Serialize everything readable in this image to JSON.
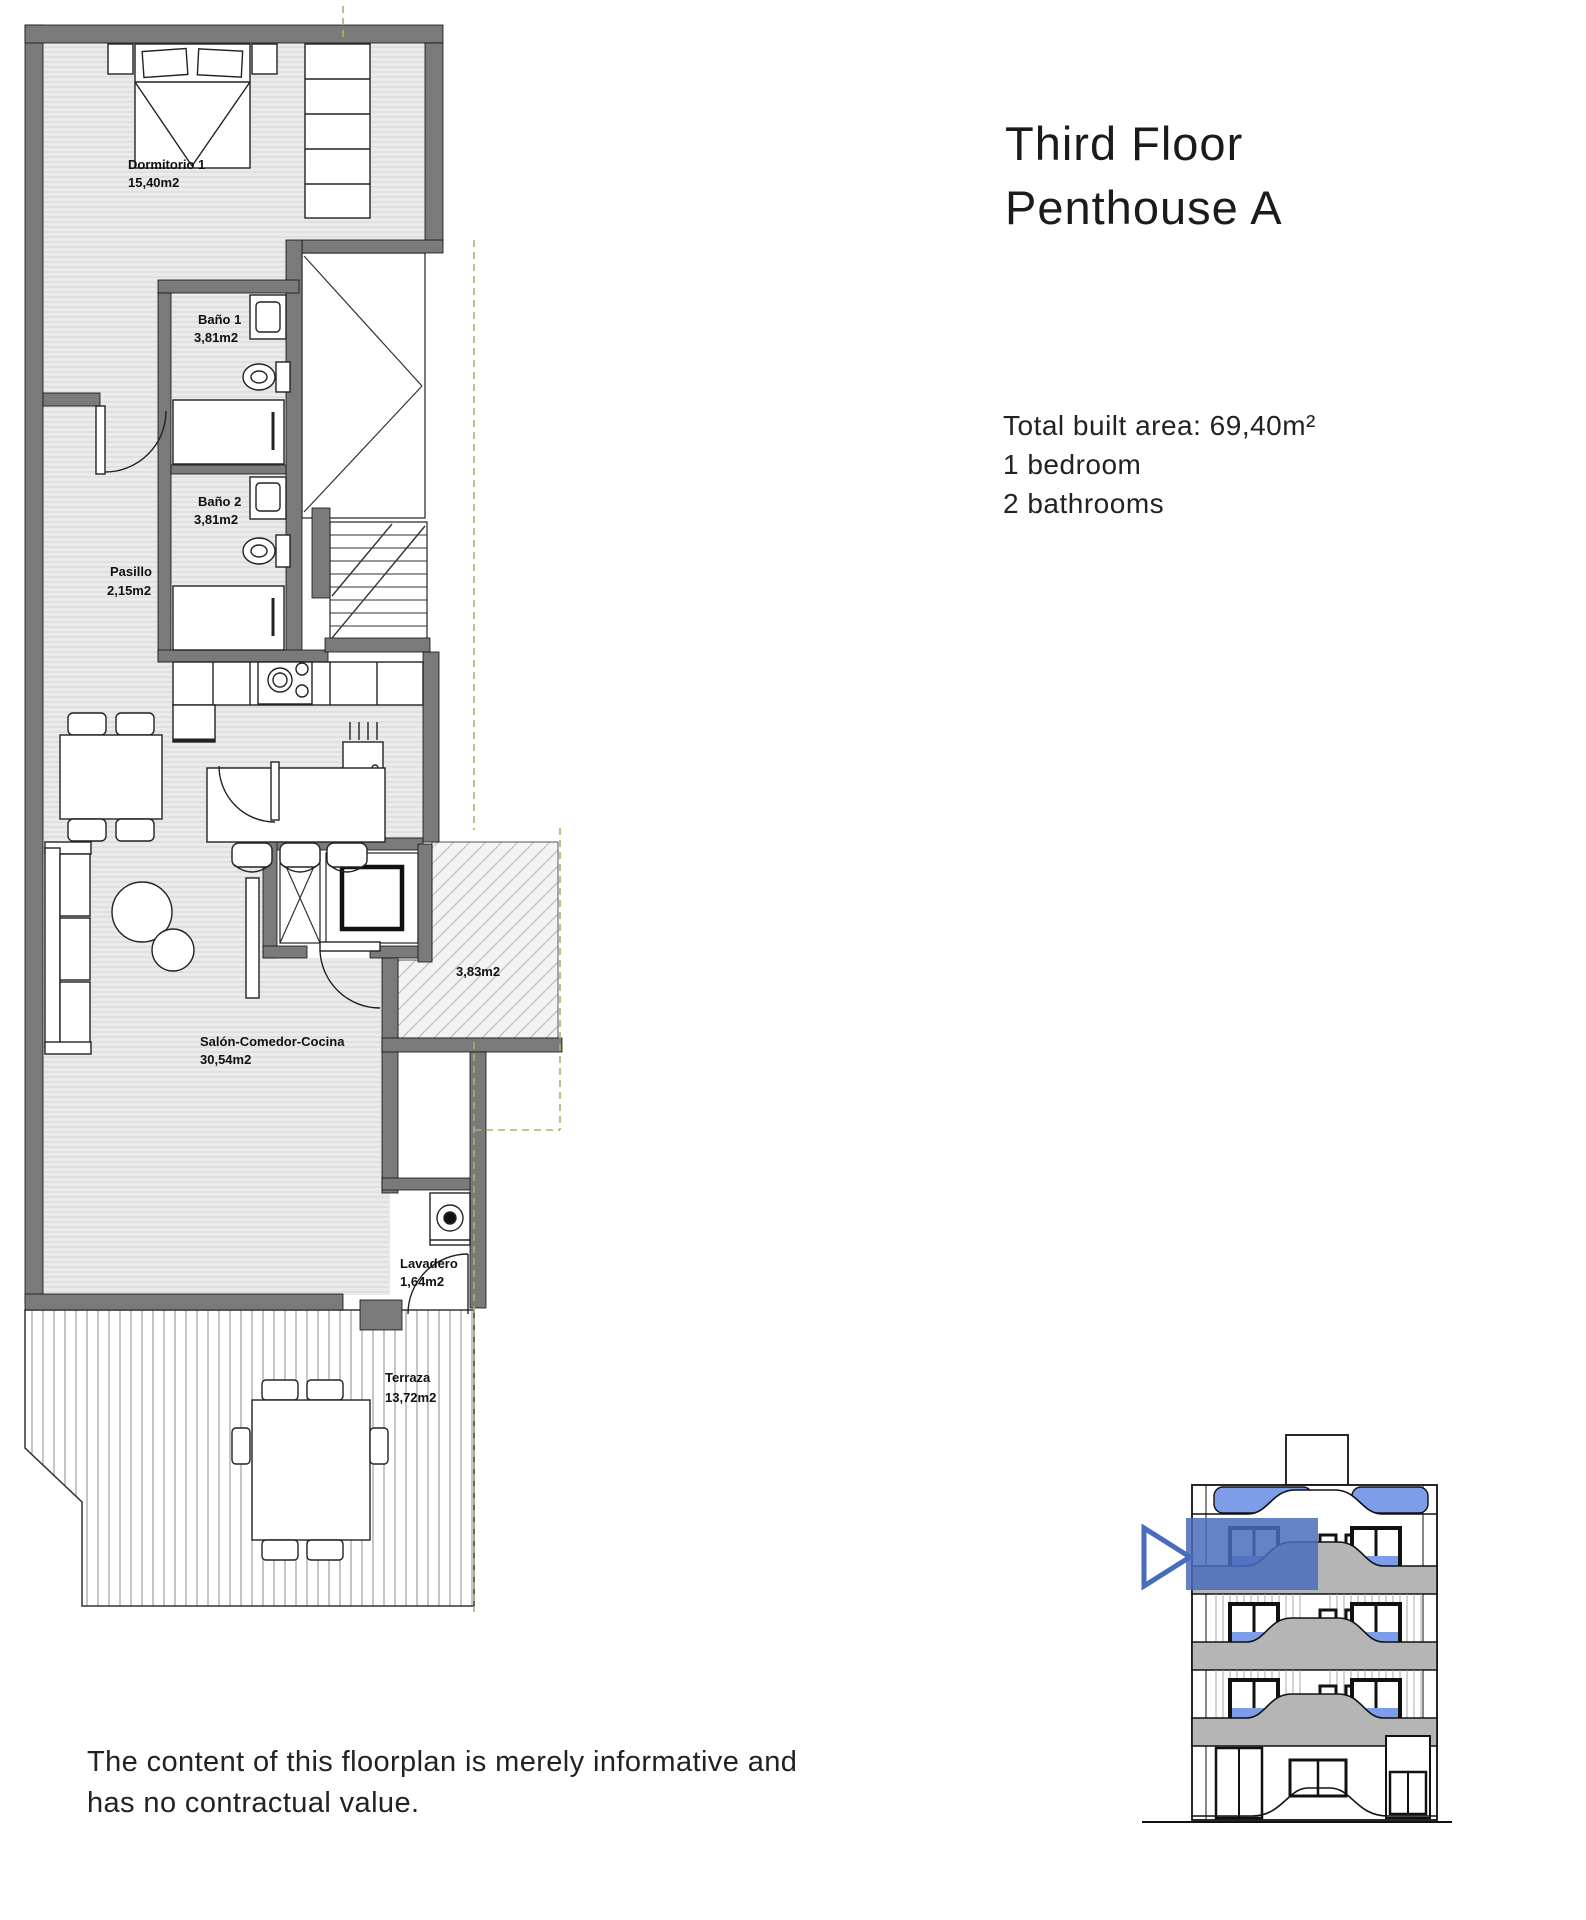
{
  "header": {
    "title_line1": "Third Floor",
    "title_line2": "Penthouse A"
  },
  "summary": {
    "total_area": "Total built area: 69,40m²",
    "bedrooms": "1 bedroom",
    "bathrooms": "2 bathrooms"
  },
  "rooms": {
    "dormitorio": {
      "name": "Dormitorio 1",
      "area": "15,40m2"
    },
    "bano1": {
      "name": "Baño 1",
      "area": "3,81m2"
    },
    "bano2": {
      "name": "Baño 2",
      "area": "3,81m2"
    },
    "pasillo": {
      "name": "Pasillo",
      "area": "2,15m2"
    },
    "salon": {
      "name": "Salón-Comedor-Cocina",
      "area": "30,54m2"
    },
    "landing": {
      "area": "3,83m2"
    },
    "lavadero": {
      "name": "Lavadero",
      "area": "1,64m2"
    },
    "terraza": {
      "name": "Terraza",
      "area": "13,72m2"
    }
  },
  "disclaimer": {
    "line1": "The content of this floorplan is merely informative and",
    "line2": "has no contractual value."
  },
  "colors": {
    "wall": "#7a7a7a",
    "floor": "#ebebeb",
    "accent_blue": "#4a6cbd",
    "glass_blue": "#7d9de8",
    "dashed_green": "#9ab86f"
  }
}
